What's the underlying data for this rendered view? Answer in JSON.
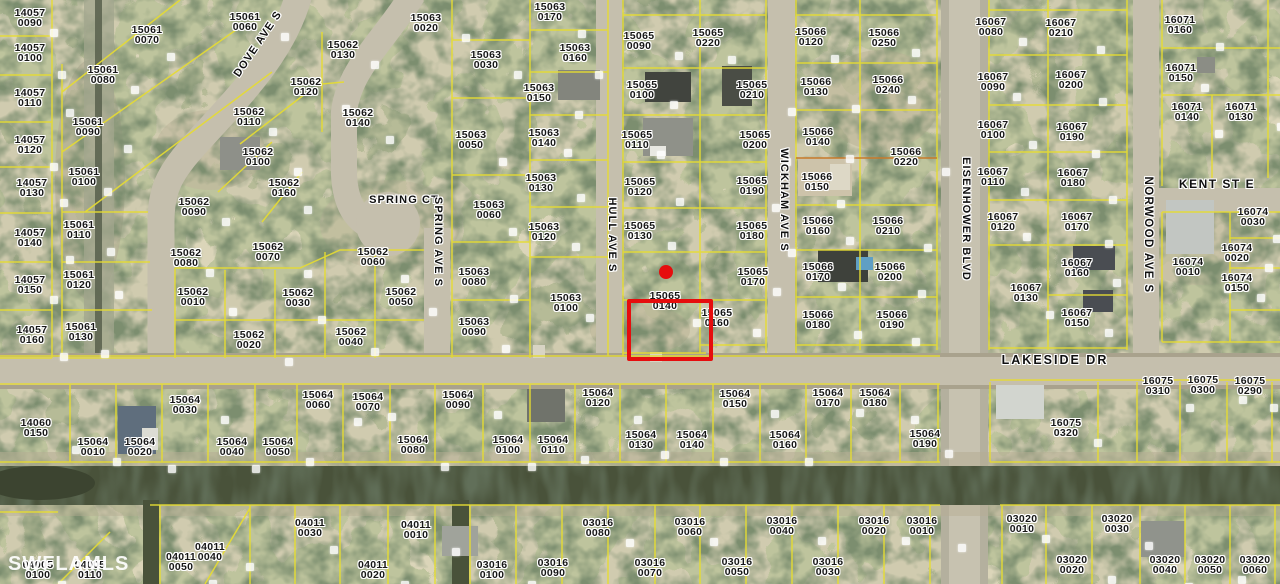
{
  "map": {
    "watermark": "SWFLAMLS",
    "colors": {
      "parcel_line": "#e6dc32",
      "subdivision_line": "#c87a2a",
      "highlight": "#e60d0d",
      "label_text": "#161616",
      "label_halo": "#ffffff",
      "road": "#c5bfad",
      "canal": "#49523a"
    },
    "highlight": {
      "x": 627,
      "y": 299,
      "w": 78,
      "h": 54,
      "dot_x": 666,
      "dot_y": 272,
      "dot_r": 7
    },
    "streets": [
      {
        "name": "DOVE AVE S",
        "x": 258,
        "y": 44,
        "rot": -56,
        "fs": 11,
        "ls": 1.1
      },
      {
        "name": "SPRING CT",
        "x": 404,
        "y": 200,
        "rot": 0,
        "fs": 11,
        "ls": 1.1
      },
      {
        "name": "SPRING AVE S",
        "x": 438,
        "y": 242,
        "rot": 90,
        "fs": 11,
        "ls": 1.1
      },
      {
        "name": "HULL AVE S",
        "x": 612,
        "y": 235,
        "rot": 90,
        "fs": 11,
        "ls": 1.1
      },
      {
        "name": "WICKHAM AVE S",
        "x": 784,
        "y": 200,
        "rot": 90,
        "fs": 11,
        "ls": 1.1
      },
      {
        "name": "EISENHOWER BLVD",
        "x": 966,
        "y": 219,
        "rot": 90,
        "fs": 11,
        "ls": 1.1
      },
      {
        "name": "NORWOOD AVE S",
        "x": 1148,
        "y": 235,
        "rot": 90,
        "fs": 11.5,
        "ls": 1.4
      },
      {
        "name": "KENT ST E",
        "x": 1217,
        "y": 184,
        "rot": 0,
        "fs": 12,
        "ls": 1.5
      },
      {
        "name": "LAKESIDE DR",
        "x": 1055,
        "y": 360,
        "rot": 0,
        "fs": 12.5,
        "ls": 2
      }
    ],
    "parcels": [
      {
        "block": "14057",
        "lot": "0090",
        "x": 30,
        "y": 18
      },
      {
        "block": "14057",
        "lot": "0100",
        "x": 30,
        "y": 53
      },
      {
        "block": "14057",
        "lot": "0110",
        "x": 30,
        "y": 98
      },
      {
        "block": "14057",
        "lot": "0120",
        "x": 30,
        "y": 145
      },
      {
        "block": "14057",
        "lot": "0130",
        "x": 32,
        "y": 188
      },
      {
        "block": "14057",
        "lot": "0140",
        "x": 30,
        "y": 238
      },
      {
        "block": "14057",
        "lot": "0150",
        "x": 30,
        "y": 285
      },
      {
        "block": "14057",
        "lot": "0160",
        "x": 32,
        "y": 335
      },
      {
        "block": "15061",
        "lot": "0060",
        "x": 245,
        "y": 22
      },
      {
        "block": "15061",
        "lot": "0070",
        "x": 147,
        "y": 35
      },
      {
        "block": "15061",
        "lot": "0080",
        "x": 103,
        "y": 75
      },
      {
        "block": "15061",
        "lot": "0090",
        "x": 88,
        "y": 127
      },
      {
        "block": "15061",
        "lot": "0100",
        "x": 84,
        "y": 177
      },
      {
        "block": "15061",
        "lot": "0110",
        "x": 79,
        "y": 230
      },
      {
        "block": "15061",
        "lot": "0120",
        "x": 79,
        "y": 280
      },
      {
        "block": "15061",
        "lot": "0130",
        "x": 81,
        "y": 332
      },
      {
        "block": "15062",
        "lot": "0130",
        "x": 343,
        "y": 50
      },
      {
        "block": "15062",
        "lot": "0120",
        "x": 306,
        "y": 87
      },
      {
        "block": "15062",
        "lot": "0110",
        "x": 249,
        "y": 117
      },
      {
        "block": "15062",
        "lot": "0140",
        "x": 358,
        "y": 118
      },
      {
        "block": "15062",
        "lot": "0100",
        "x": 258,
        "y": 157
      },
      {
        "block": "15062",
        "lot": "0160",
        "x": 284,
        "y": 188
      },
      {
        "block": "15062",
        "lot": "0090",
        "x": 194,
        "y": 207
      },
      {
        "block": "15062",
        "lot": "0070",
        "x": 268,
        "y": 252
      },
      {
        "block": "15062",
        "lot": "0080",
        "x": 186,
        "y": 258
      },
      {
        "block": "15062",
        "lot": "0060",
        "x": 373,
        "y": 257
      },
      {
        "block": "15062",
        "lot": "0010",
        "x": 193,
        "y": 297
      },
      {
        "block": "15062",
        "lot": "0030",
        "x": 298,
        "y": 298
      },
      {
        "block": "15062",
        "lot": "0050",
        "x": 401,
        "y": 297
      },
      {
        "block": "15062",
        "lot": "0020",
        "x": 249,
        "y": 340
      },
      {
        "block": "15062",
        "lot": "0040",
        "x": 351,
        "y": 337
      },
      {
        "block": "15063",
        "lot": "0170",
        "x": 550,
        "y": 12
      },
      {
        "block": "15063",
        "lot": "0020",
        "x": 426,
        "y": 23
      },
      {
        "block": "15063",
        "lot": "0160",
        "x": 575,
        "y": 53
      },
      {
        "block": "15063",
        "lot": "0030",
        "x": 486,
        "y": 60
      },
      {
        "block": "15063",
        "lot": "0150",
        "x": 539,
        "y": 93
      },
      {
        "block": "15063",
        "lot": "0140",
        "x": 544,
        "y": 138
      },
      {
        "block": "15063",
        "lot": "0050",
        "x": 471,
        "y": 140
      },
      {
        "block": "15063",
        "lot": "0130",
        "x": 541,
        "y": 183
      },
      {
        "block": "15063",
        "lot": "0060",
        "x": 489,
        "y": 210
      },
      {
        "block": "15063",
        "lot": "0120",
        "x": 544,
        "y": 232
      },
      {
        "block": "15063",
        "lot": "0080",
        "x": 474,
        "y": 277
      },
      {
        "block": "15063",
        "lot": "0100",
        "x": 566,
        "y": 303
      },
      {
        "block": "15063",
        "lot": "0090",
        "x": 474,
        "y": 327
      },
      {
        "block": "15065",
        "lot": "0090",
        "x": 639,
        "y": 41
      },
      {
        "block": "15065",
        "lot": "0220",
        "x": 708,
        "y": 38
      },
      {
        "block": "15065",
        "lot": "0100",
        "x": 642,
        "y": 90
      },
      {
        "block": "15065",
        "lot": "0210",
        "x": 752,
        "y": 90
      },
      {
        "block": "15065",
        "lot": "0110",
        "x": 637,
        "y": 140
      },
      {
        "block": "15065",
        "lot": "0200",
        "x": 755,
        "y": 140
      },
      {
        "block": "15065",
        "lot": "0120",
        "x": 640,
        "y": 187
      },
      {
        "block": "15065",
        "lot": "0190",
        "x": 752,
        "y": 186
      },
      {
        "block": "15065",
        "lot": "0130",
        "x": 640,
        "y": 231
      },
      {
        "block": "15065",
        "lot": "0180",
        "x": 752,
        "y": 231
      },
      {
        "block": "15065",
        "lot": "0170",
        "x": 753,
        "y": 277
      },
      {
        "block": "15065",
        "lot": "0140",
        "x": 665,
        "y": 301
      },
      {
        "block": "15065",
        "lot": "0160",
        "x": 717,
        "y": 318
      },
      {
        "block": "15066",
        "lot": "0120",
        "x": 811,
        "y": 37
      },
      {
        "block": "15066",
        "lot": "0250",
        "x": 884,
        "y": 38
      },
      {
        "block": "15066",
        "lot": "0130",
        "x": 816,
        "y": 87
      },
      {
        "block": "15066",
        "lot": "0240",
        "x": 888,
        "y": 85
      },
      {
        "block": "15066",
        "lot": "0140",
        "x": 818,
        "y": 137
      },
      {
        "block": "15066",
        "lot": "0220",
        "x": 906,
        "y": 157
      },
      {
        "block": "15066",
        "lot": "0150",
        "x": 817,
        "y": 182
      },
      {
        "block": "15066",
        "lot": "0160",
        "x": 818,
        "y": 226
      },
      {
        "block": "15066",
        "lot": "0210",
        "x": 888,
        "y": 226
      },
      {
        "block": "15066",
        "lot": "0170",
        "x": 818,
        "y": 272
      },
      {
        "block": "15066",
        "lot": "0200",
        "x": 890,
        "y": 272
      },
      {
        "block": "15066",
        "lot": "0180",
        "x": 818,
        "y": 320
      },
      {
        "block": "15066",
        "lot": "0190",
        "x": 892,
        "y": 320
      },
      {
        "block": "16067",
        "lot": "0080",
        "x": 991,
        "y": 27
      },
      {
        "block": "16067",
        "lot": "0210",
        "x": 1061,
        "y": 28
      },
      {
        "block": "16067",
        "lot": "0090",
        "x": 993,
        "y": 82
      },
      {
        "block": "16067",
        "lot": "0200",
        "x": 1071,
        "y": 80
      },
      {
        "block": "16067",
        "lot": "0100",
        "x": 993,
        "y": 130
      },
      {
        "block": "16067",
        "lot": "0190",
        "x": 1072,
        "y": 132
      },
      {
        "block": "16067",
        "lot": "0110",
        "x": 993,
        "y": 177
      },
      {
        "block": "16067",
        "lot": "0180",
        "x": 1073,
        "y": 178
      },
      {
        "block": "16067",
        "lot": "0120",
        "x": 1003,
        "y": 222
      },
      {
        "block": "16067",
        "lot": "0170",
        "x": 1077,
        "y": 222
      },
      {
        "block": "16067",
        "lot": "0160",
        "x": 1077,
        "y": 268
      },
      {
        "block": "16067",
        "lot": "0130",
        "x": 1026,
        "y": 293
      },
      {
        "block": "16067",
        "lot": "0150",
        "x": 1077,
        "y": 318
      },
      {
        "block": "16071",
        "lot": "0160",
        "x": 1180,
        "y": 25
      },
      {
        "block": "16071",
        "lot": "0150",
        "x": 1181,
        "y": 73
      },
      {
        "block": "16071",
        "lot": "0140",
        "x": 1187,
        "y": 112
      },
      {
        "block": "16071",
        "lot": "0130",
        "x": 1241,
        "y": 112
      },
      {
        "block": "16074",
        "lot": "0030",
        "x": 1253,
        "y": 217
      },
      {
        "block": "16074",
        "lot": "0020",
        "x": 1237,
        "y": 253
      },
      {
        "block": "16074",
        "lot": "0010",
        "x": 1188,
        "y": 267
      },
      {
        "block": "16074",
        "lot": "0150",
        "x": 1237,
        "y": 283
      },
      {
        "block": "16075",
        "lot": "0310",
        "x": 1158,
        "y": 386
      },
      {
        "block": "16075",
        "lot": "0300",
        "x": 1203,
        "y": 385
      },
      {
        "block": "16075",
        "lot": "0290",
        "x": 1250,
        "y": 386
      },
      {
        "block": "16075",
        "lot": "0320",
        "x": 1066,
        "y": 428
      },
      {
        "block": "14060",
        "lot": "0150",
        "x": 36,
        "y": 428
      },
      {
        "block": "15064",
        "lot": "0010",
        "x": 93,
        "y": 447
      },
      {
        "block": "15064",
        "lot": "0020",
        "x": 140,
        "y": 447
      },
      {
        "block": "15064",
        "lot": "0030",
        "x": 185,
        "y": 405
      },
      {
        "block": "15064",
        "lot": "0040",
        "x": 232,
        "y": 447
      },
      {
        "block": "15064",
        "lot": "0050",
        "x": 278,
        "y": 447
      },
      {
        "block": "15064",
        "lot": "0060",
        "x": 318,
        "y": 400
      },
      {
        "block": "15064",
        "lot": "0070",
        "x": 368,
        "y": 402
      },
      {
        "block": "15064",
        "lot": "0080",
        "x": 413,
        "y": 445
      },
      {
        "block": "15064",
        "lot": "0090",
        "x": 458,
        "y": 400
      },
      {
        "block": "15064",
        "lot": "0100",
        "x": 508,
        "y": 445
      },
      {
        "block": "15064",
        "lot": "0110",
        "x": 553,
        "y": 445
      },
      {
        "block": "15064",
        "lot": "0120",
        "x": 598,
        "y": 398
      },
      {
        "block": "15064",
        "lot": "0130",
        "x": 641,
        "y": 440
      },
      {
        "block": "15064",
        "lot": "0140",
        "x": 692,
        "y": 440
      },
      {
        "block": "15064",
        "lot": "0150",
        "x": 735,
        "y": 399
      },
      {
        "block": "15064",
        "lot": "0160",
        "x": 785,
        "y": 440
      },
      {
        "block": "15064",
        "lot": "0170",
        "x": 828,
        "y": 398
      },
      {
        "block": "15064",
        "lot": "0180",
        "x": 875,
        "y": 398
      },
      {
        "block": "15064",
        "lot": "0190",
        "x": 925,
        "y": 439
      },
      {
        "block": "04011",
        "lot": "0050",
        "x": 181,
        "y": 562
      },
      {
        "block": "04011",
        "lot": "0040",
        "x": 210,
        "y": 552
      },
      {
        "block": "04011",
        "lot": "0030",
        "x": 310,
        "y": 528
      },
      {
        "block": "04011",
        "lot": "0020",
        "x": 373,
        "y": 570
      },
      {
        "block": "04011",
        "lot": "0010",
        "x": 416,
        "y": 530
      },
      {
        "block": "04005",
        "lot": "0100",
        "x": 38,
        "y": 570
      },
      {
        "block": "04005",
        "lot": "0110",
        "x": 90,
        "y": 570
      },
      {
        "block": "03016",
        "lot": "0100",
        "x": 492,
        "y": 570
      },
      {
        "block": "03016",
        "lot": "0090",
        "x": 553,
        "y": 568
      },
      {
        "block": "03016",
        "lot": "0080",
        "x": 598,
        "y": 528
      },
      {
        "block": "03016",
        "lot": "0070",
        "x": 650,
        "y": 568
      },
      {
        "block": "03016",
        "lot": "0060",
        "x": 690,
        "y": 527
      },
      {
        "block": "03016",
        "lot": "0050",
        "x": 737,
        "y": 567
      },
      {
        "block": "03016",
        "lot": "0040",
        "x": 782,
        "y": 526
      },
      {
        "block": "03016",
        "lot": "0030",
        "x": 828,
        "y": 567
      },
      {
        "block": "03016",
        "lot": "0020",
        "x": 874,
        "y": 526
      },
      {
        "block": "03016",
        "lot": "0010",
        "x": 922,
        "y": 526
      },
      {
        "block": "03020",
        "lot": "0010",
        "x": 1022,
        "y": 524
      },
      {
        "block": "03020",
        "lot": "0030",
        "x": 1117,
        "y": 524
      },
      {
        "block": "03020",
        "lot": "0020",
        "x": 1072,
        "y": 565
      },
      {
        "block": "03020",
        "lot": "0040",
        "x": 1165,
        "y": 565
      },
      {
        "block": "03020",
        "lot": "0050",
        "x": 1210,
        "y": 565
      },
      {
        "block": "03020",
        "lot": "0060",
        "x": 1255,
        "y": 565
      }
    ]
  }
}
